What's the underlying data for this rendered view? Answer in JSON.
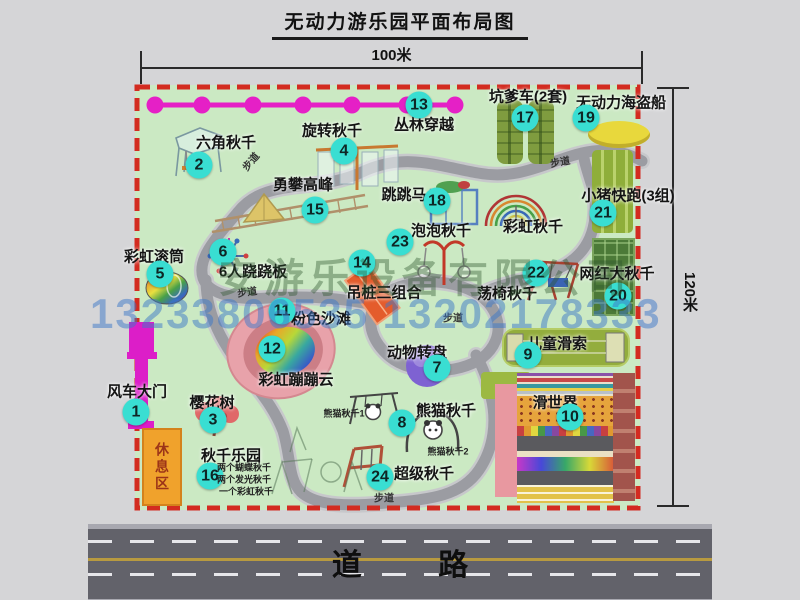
{
  "title": "无动力游乐园平面布局图",
  "dimensions": {
    "width_label": "100米",
    "height_label": "120米"
  },
  "road": {
    "label": "道 路"
  },
  "watermark": {
    "company": "安游乐设备有限公司",
    "phones": "13233806535 13202178333"
  },
  "rest_area": {
    "label": "休息区"
  },
  "colors": {
    "map_green": "#cbe9c3",
    "border_red": "#d32b20",
    "badge_cyan": "#39ded2",
    "chain_magenta": "#e520c6",
    "gate_magenta": "#dc1ec8",
    "road_gray": "#62626a",
    "rest_orange": "#f0a22c"
  },
  "map": {
    "attractions": [
      {
        "num": "1",
        "name": "风车大门",
        "bx": 136,
        "by": 412,
        "lx": 137,
        "ly": 391
      },
      {
        "num": "2",
        "name": "六角秋千",
        "bx": 199,
        "by": 165,
        "lx": 226,
        "ly": 142
      },
      {
        "num": "3",
        "name": "樱花树",
        "bx": 213,
        "by": 420,
        "lx": 212,
        "ly": 402
      },
      {
        "num": "4",
        "name": "旋转秋千",
        "bx": 344,
        "by": 151,
        "lx": 332,
        "ly": 130
      },
      {
        "num": "5",
        "name": "彩虹滚筒",
        "bx": 160,
        "by": 274,
        "lx": 154,
        "ly": 256
      },
      {
        "num": "6",
        "name": "6人跷跷板",
        "bx": 223,
        "by": 252,
        "lx": 253,
        "ly": 271
      },
      {
        "num": "7",
        "name": "动物转盘",
        "bx": 437,
        "by": 368,
        "lx": 417,
        "ly": 352
      },
      {
        "num": "8",
        "name": "熊猫秋千",
        "bx": 402,
        "by": 423,
        "lx": 446,
        "ly": 410
      },
      {
        "num": "9",
        "name": "儿童滑索",
        "bx": 528,
        "by": 355,
        "lx": 557,
        "ly": 343
      },
      {
        "num": "10",
        "name": "滑世界",
        "bx": 570,
        "by": 417,
        "lx": 555,
        "ly": 402
      },
      {
        "num": "11",
        "name": "粉色沙滩",
        "bx": 282,
        "by": 311,
        "lx": 321,
        "ly": 318
      },
      {
        "num": "12",
        "name": "彩虹蹦蹦云",
        "bx": 272,
        "by": 349,
        "lx": 296,
        "ly": 379
      },
      {
        "num": "13",
        "name": "丛林穿越",
        "bx": 419,
        "by": 105,
        "lx": 424,
        "ly": 124
      },
      {
        "num": "14",
        "name": "吊桩三组合",
        "bx": 362,
        "by": 263,
        "lx": 384,
        "ly": 292
      },
      {
        "num": "15",
        "name": "勇攀高峰",
        "bx": 315,
        "by": 210,
        "lx": 303,
        "ly": 184
      },
      {
        "num": "16",
        "name": "秋千乐园",
        "bx": 210,
        "by": 476,
        "lx": 231,
        "ly": 455
      },
      {
        "num": "17",
        "name": "坑爹车(2套)",
        "bx": 525,
        "by": 118,
        "lx": 528,
        "ly": 96
      },
      {
        "num": "18",
        "name": "跳跳马",
        "bx": 437,
        "by": 201,
        "lx": 404,
        "ly": 194
      },
      {
        "num": "19",
        "name": "无动力海盗船",
        "bx": 586,
        "by": 118,
        "lx": 621,
        "ly": 102
      },
      {
        "num": "20",
        "name": "网红大秋千",
        "bx": 618,
        "by": 296,
        "lx": 617,
        "ly": 273
      },
      {
        "num": "21",
        "name": "小猪快跑(3组)",
        "bx": 603,
        "by": 213,
        "lx": 628,
        "ly": 195
      },
      {
        "num": "22",
        "name": "荡椅秋千",
        "bx": 536,
        "by": 273,
        "lx": 507,
        "ly": 293
      },
      {
        "num": "23",
        "name": "泡泡秋千",
        "bx": 400,
        "by": 242,
        "lx": 441,
        "ly": 230
      },
      {
        "num": "24",
        "name": "超级秋千",
        "bx": 380,
        "by": 477,
        "lx": 424,
        "ly": 473
      },
      {
        "num": null,
        "name": "彩虹秋千",
        "bx": null,
        "by": null,
        "lx": 533,
        "ly": 226
      }
    ],
    "notes": [
      {
        "text": "熊猫秋千1",
        "x": 344,
        "y": 413
      },
      {
        "text": "熊猫秋千2",
        "x": 448,
        "y": 451
      },
      {
        "text": "两个蝴蝶秋千",
        "x": 244,
        "y": 467
      },
      {
        "text": "两个发光秋千",
        "x": 244,
        "y": 479
      },
      {
        "text": "一个彩虹秋千",
        "x": 246,
        "y": 491
      }
    ],
    "walkway_labels": [
      {
        "text": "步道",
        "x": 250,
        "y": 161,
        "rot": -50
      },
      {
        "text": "步道",
        "x": 560,
        "y": 161,
        "rot": -10
      },
      {
        "text": "步道",
        "x": 247,
        "y": 291,
        "rot": -8
      },
      {
        "text": "步道",
        "x": 453,
        "y": 317,
        "rot": 0
      },
      {
        "text": "步道",
        "x": 384,
        "y": 497,
        "rot": 0
      }
    ]
  }
}
